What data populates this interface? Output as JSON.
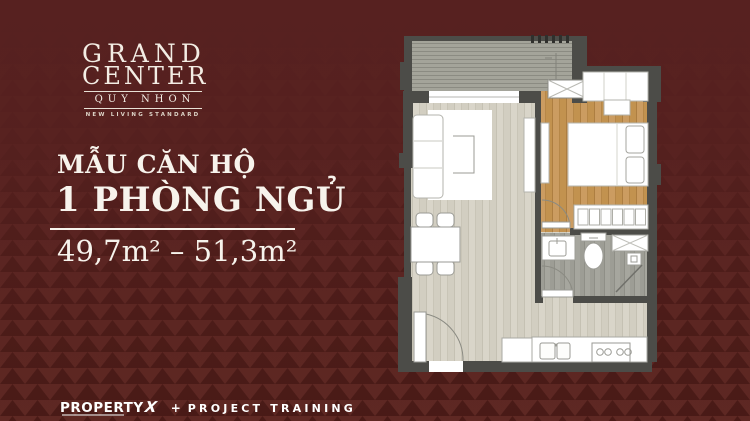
{
  "logo": {
    "name_line1": "GRAND",
    "name_line2": "CENTER",
    "location": "QUY NHON",
    "tagline": "NEW LIVING STANDARD"
  },
  "headline": {
    "eyebrow": "MẪU CĂN HỘ",
    "title": "1 PHÒNG NGỦ",
    "area_range": "49,7m² – 51,3m²"
  },
  "footer": {
    "brand": "PROPERTY",
    "brand_x": "X",
    "plus": "+",
    "program": "PROJECT TRAINING"
  },
  "colors": {
    "background_base": "#572120",
    "pattern_base": "#5e2823",
    "pattern_triangle_dark": "#481a16",
    "wall": "#4c4c48",
    "balcony_floor": "#a4a49a",
    "living_floor": "#d9d5c9",
    "bedroom_floor": "#c9995e",
    "bathroom_floor": "#a6a69e",
    "furniture_white": "#ffffff",
    "text_white": "#f7f3ec"
  },
  "floorplan": {
    "rooms": [
      "balcony",
      "living-room",
      "bedroom",
      "bathroom",
      "kitchen",
      "dining-area",
      "entry"
    ],
    "furniture": [
      "sofa",
      "rug",
      "coffee-table",
      "tv-console",
      "dining-table",
      "dining-chairs",
      "bed",
      "pillows",
      "wardrobe",
      "nightstand",
      "dresser",
      "bedroom-shelf",
      "vanity-sink",
      "toilet",
      "shower",
      "washer-box",
      "ac-ledge",
      "kitchen-counter",
      "kitchen-sink",
      "cooktop",
      "fridge",
      "entry-door",
      "bedroom-door",
      "bathroom-door",
      "balcony-window"
    ]
  }
}
